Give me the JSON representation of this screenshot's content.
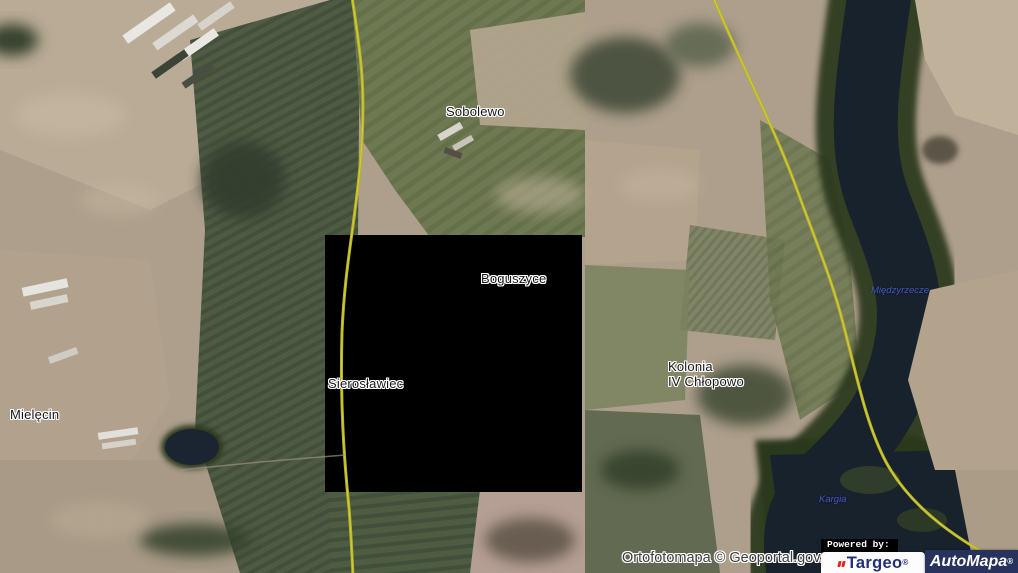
{
  "map": {
    "places": [
      {
        "name": "Sobolewo"
      },
      {
        "name": "Boguszyce"
      },
      {
        "name": "Sierosławiec"
      },
      {
        "name": "Kolonia IV Chłopowo",
        "line1": "Kolonia",
        "line2": "IV Chłopowo"
      },
      {
        "name": "Mielęcin"
      }
    ],
    "water_labels": [
      {
        "name": "Międzyrzecze"
      },
      {
        "name": "Kargia"
      }
    ]
  },
  "attribution": {
    "text": "Ortofotomapa © Geoportal.gov.pl"
  },
  "branding": {
    "powered_by": "Powered by:",
    "targeo": {
      "name": "Targeo",
      "registered": "®"
    },
    "automapa": {
      "name": "AutoMapa",
      "registered": "®"
    }
  },
  "colors": {
    "road": "#b7b22b",
    "water": "#18222c",
    "missing_tile": "#000000",
    "water_label": "#4a5ed2",
    "targeo_blue": "#22307a",
    "targeo_red": "#e0271c",
    "automapa_bg": "#27335c"
  }
}
